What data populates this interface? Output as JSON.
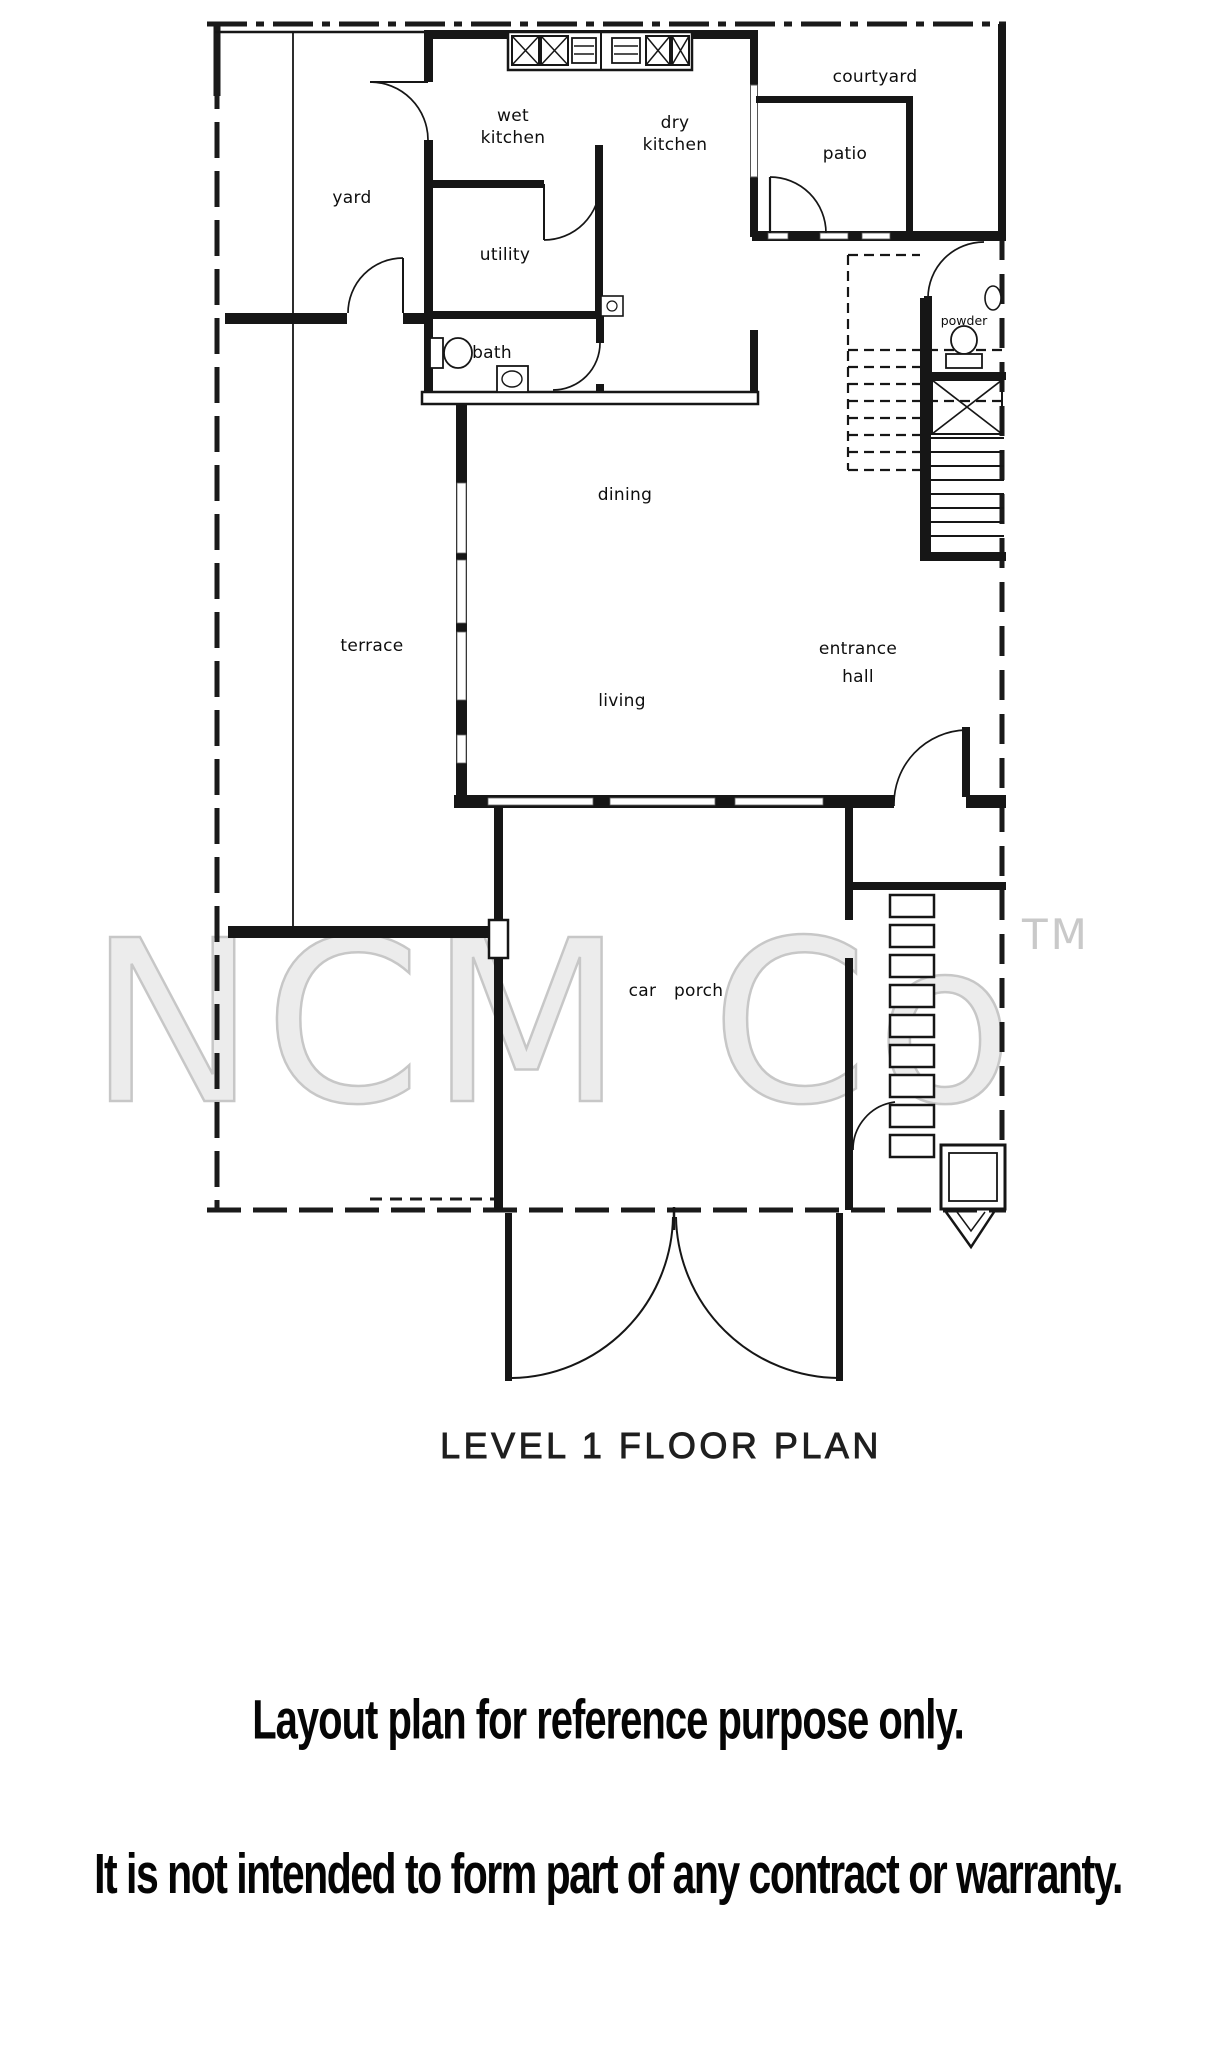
{
  "title": "LEVEL 1 FLOOR PLAN",
  "watermark": {
    "text": "NCM Co",
    "tm": "TM"
  },
  "disclaimer": {
    "line1": "Layout plan for reference purpose only.",
    "line2": "It is not intended to form part of any contract or warranty."
  },
  "rooms": {
    "yard": "yard",
    "wet_kitchen_line1": "wet",
    "wet_kitchen_line2": "kitchen",
    "dry_kitchen_line1": "dry",
    "dry_kitchen_line2": "kitchen",
    "courtyard": "courtyard",
    "patio": "patio",
    "utility": "utility",
    "bath": "bath",
    "powder": "powder",
    "dining": "dining",
    "living": "living",
    "terrace": "terrace",
    "entrance_hall_line1": "entrance",
    "entrance_hall_line2": "hall",
    "car_porch": "car porch"
  },
  "colors": {
    "line": "#1a1a1a",
    "watermark": "#c7c7c7"
  }
}
